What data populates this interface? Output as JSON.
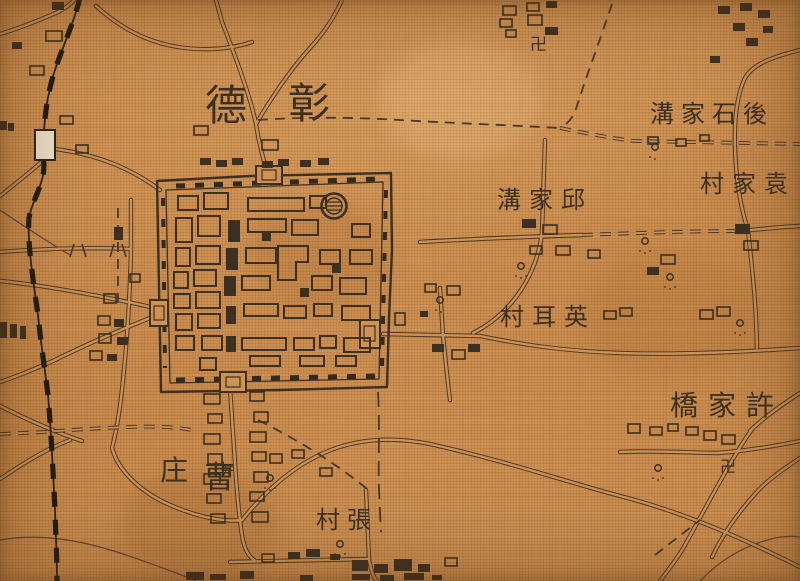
{
  "title": {
    "left_char": "德",
    "right_char": "彰"
  },
  "places": [
    {
      "key": "houshijiagou",
      "text": "溝家石後"
    },
    {
      "key": "yuanjiacun",
      "text": "村家袁"
    },
    {
      "key": "qiujiagou",
      "text": "溝家邱"
    },
    {
      "key": "yingercun",
      "text": "村耳英"
    },
    {
      "key": "xujiaqiao",
      "text": "橋家許"
    },
    {
      "key": "caozhuang_zhuang",
      "text": "庄"
    },
    {
      "key": "caozhuang_cao",
      "text": "曹"
    },
    {
      "key": "zhangcun",
      "text": "村張"
    }
  ],
  "symbols": {
    "temple_swastika": "卍",
    "well": "井"
  },
  "colors": {
    "fabric": "#cf9254",
    "ink": "#3b3021",
    "road": "#4a3a28",
    "railway": "#211b14",
    "station_fill": "#eadfc7"
  }
}
